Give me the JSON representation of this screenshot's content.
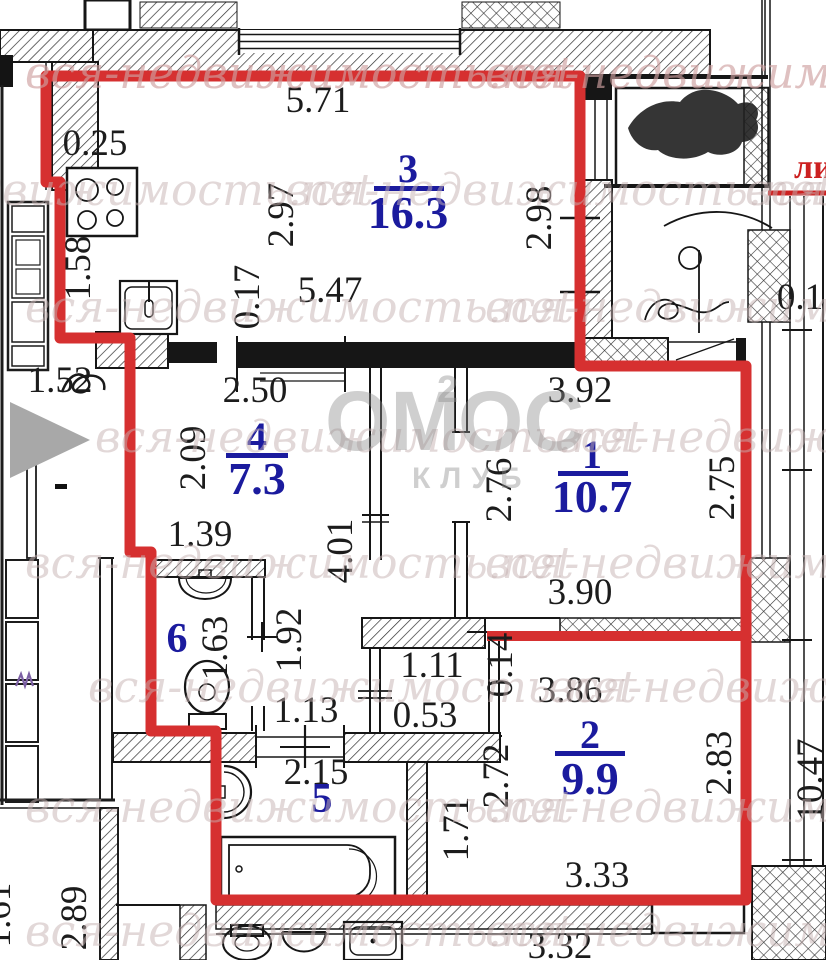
{
  "watermark": {
    "text": "вся-недвижимость.net"
  },
  "logo": {
    "pre": "ОМ",
    "sup": "2",
    "post": "ОС",
    "sub": "КЛУБ"
  },
  "hall_label": "ли",
  "rooms": {
    "r1": {
      "number": "1",
      "area": "10.7"
    },
    "r2": {
      "number": "2",
      "area": "9.9"
    },
    "r3": {
      "number": "3",
      "area": "16.3"
    },
    "r4": {
      "number": "4",
      "area": "7.3"
    },
    "r5": {
      "number": "5"
    },
    "r6": {
      "number": "6"
    }
  },
  "dims": {
    "d571": "5.71",
    "d025": "0.25",
    "d158": "1.58",
    "d297": "2.97",
    "d017": "0.17",
    "d547": "5.47",
    "d298": "2.98",
    "d250": "2.50",
    "d392": "3.92",
    "d152": "1.52",
    "d209": "2.09",
    "d276": "2.76",
    "d275": "2.75",
    "d139": "1.39",
    "d401": "4.01",
    "d390": "3.90",
    "d163": "1.63",
    "d192": "1.92",
    "d111": "1.11",
    "d053": "0.53",
    "d014": "0.14",
    "d113": "1.13",
    "d215": "2.15",
    "d386": "3.86",
    "d272": "2.72",
    "d171": "1.71",
    "d283": "2.83",
    "d333": "3.33",
    "d289": "2.89",
    "d161": "1.61",
    "d332": "3.32",
    "d01": "0.1",
    "d1047": "10.47"
  },
  "colors": {
    "boundary_red": "#d63030",
    "label_blue": "#1b1b9e",
    "wall_black": "#161616",
    "watermark_gray": "#c6b2b2"
  }
}
